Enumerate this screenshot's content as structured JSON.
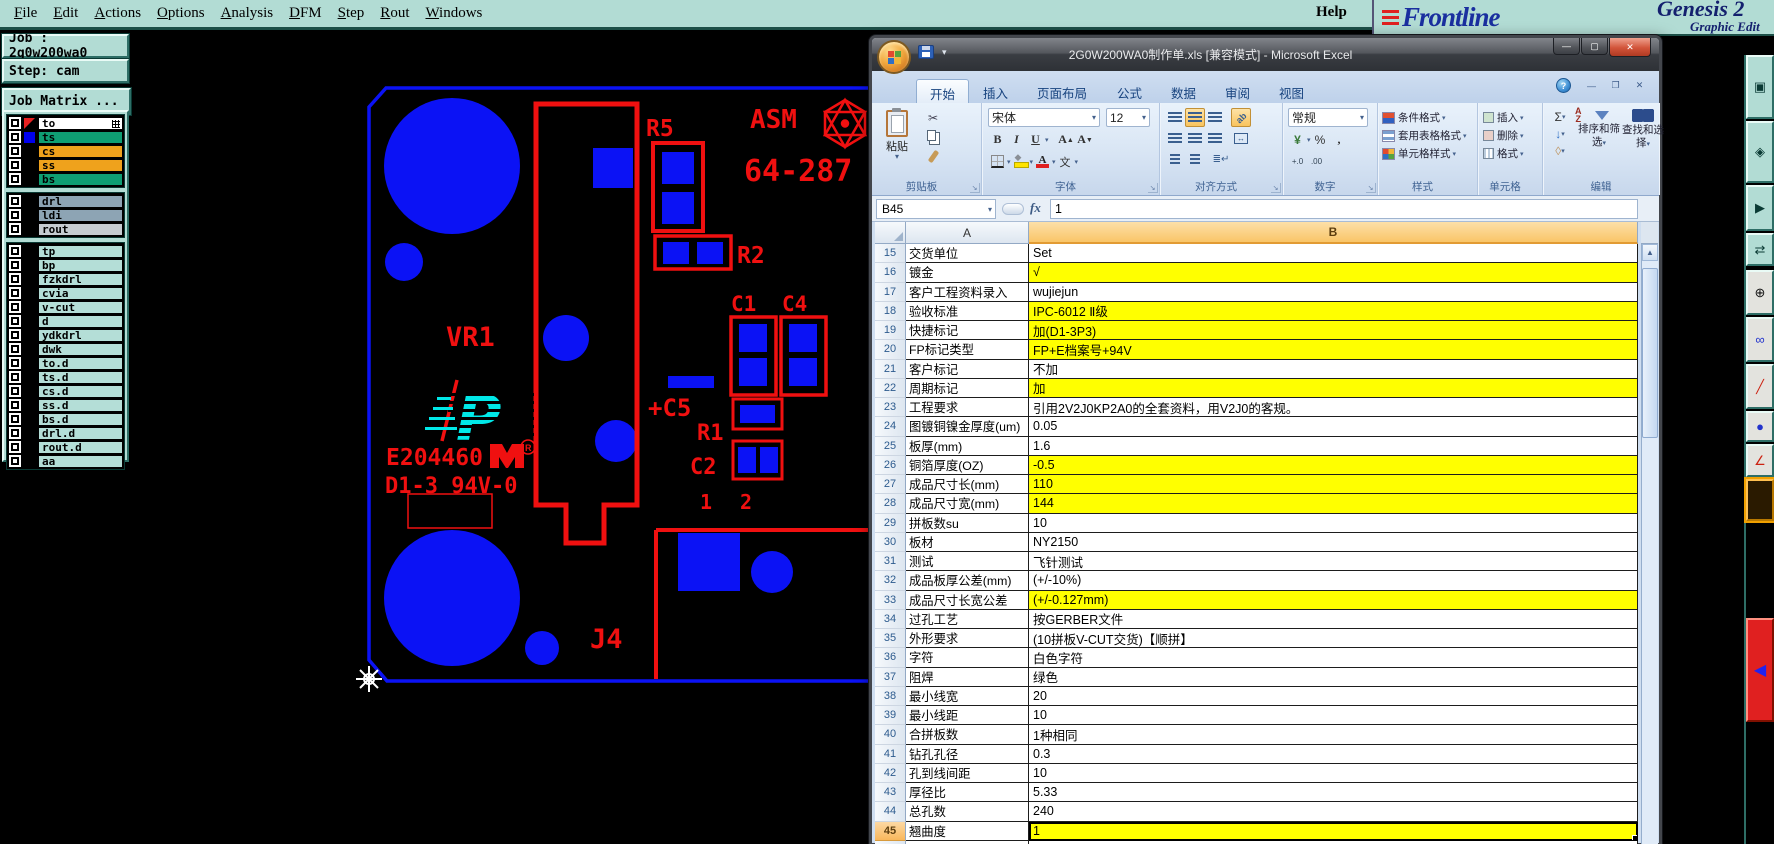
{
  "genesis": {
    "menu": [
      "File",
      "Edit",
      "Actions",
      "Options",
      "Analysis",
      "DFM",
      "Step",
      "Rout",
      "Windows"
    ],
    "help_label": "Help",
    "brand": {
      "name": "Frontline",
      "product": "Genesis 2",
      "subtitle": "Graphic Edit"
    },
    "job_label": "Job : 2g0w200wa0",
    "step_label": "Step: cam",
    "job_matrix_button": "Job Matrix ...",
    "layers": [
      {
        "name": "to",
        "label_bg": "#ffffff",
        "group": 1,
        "active": true,
        "grid_icon": true
      },
      {
        "name": "ts",
        "label_bg": "#0f9e73",
        "group": 1,
        "swatch": "#0000ee"
      },
      {
        "name": "cs",
        "label_bg": "#efa21c",
        "group": 1
      },
      {
        "name": "ss",
        "label_bg": "#efa21c",
        "group": 1
      },
      {
        "name": "bs",
        "label_bg": "#0f9e73",
        "group": 1
      },
      {
        "name": "drl",
        "label_bg": "#8da4b4",
        "group": 2
      },
      {
        "name": "ldi",
        "label_bg": "#8da4b4",
        "group": 2
      },
      {
        "name": "rout",
        "label_bg": "#c5cbd0",
        "group": 2
      },
      {
        "name": "tp",
        "label_bg": "#b4ded7",
        "group": 3
      },
      {
        "name": "bp",
        "label_bg": "#b4ded7",
        "group": 3
      },
      {
        "name": "fzkdrl",
        "label_bg": "#b4ded7",
        "group": 3
      },
      {
        "name": "cvia",
        "label_bg": "#b4ded7",
        "group": 3
      },
      {
        "name": "v-cut",
        "label_bg": "#b4ded7",
        "group": 3
      },
      {
        "name": "d",
        "label_bg": "#b4ded7",
        "group": 3
      },
      {
        "name": "ydkdrl",
        "label_bg": "#b4ded7",
        "group": 3
      },
      {
        "name": "dwk",
        "label_bg": "#b4ded7",
        "group": 3
      },
      {
        "name": "to.d",
        "label_bg": "#b4ded7",
        "group": 3
      },
      {
        "name": "ts.d",
        "label_bg": "#b4ded7",
        "group": 3
      },
      {
        "name": "cs.d",
        "label_bg": "#b4ded7",
        "group": 3
      },
      {
        "name": "ss.d",
        "label_bg": "#b4ded7",
        "group": 3
      },
      {
        "name": "bs.d",
        "label_bg": "#b4ded7",
        "group": 3
      },
      {
        "name": "drl.d",
        "label_bg": "#b4ded7",
        "group": 3
      },
      {
        "name": "rout.d",
        "label_bg": "#b4ded7",
        "group": 3
      },
      {
        "name": "aa",
        "label_bg": "#b4ded7",
        "group": 3
      }
    ],
    "pcb": {
      "r5": "R5",
      "asm": "ASM",
      "part_number": "64-287",
      "r2": "R2",
      "c1": "C1",
      "c4": "C4",
      "vr1": "VR1",
      "c5": "+C5",
      "r1": "R1",
      "c2": "C2",
      "pin1": "1",
      "pin2": "2",
      "j4": "J4",
      "ul_code": "E204460",
      "rating": "D1-3 94V-0",
      "colors": {
        "copper_blue": "#0b12f5",
        "silkscreen_red": "#f01010",
        "logo_cyan": "#00e8e8"
      }
    },
    "right_toolbar": [
      {
        "name": "window-button",
        "style": "teal"
      },
      {
        "name": "diamond-button",
        "style": "teal"
      },
      {
        "name": "play-button",
        "style": "teal"
      },
      {
        "name": "swap-button",
        "style": "teal"
      },
      {
        "name": "crosshair-button",
        "style": "light"
      },
      {
        "name": "link-button",
        "style": "light"
      },
      {
        "name": "slash-button",
        "style": "light"
      },
      {
        "name": "dot-button",
        "style": "light"
      },
      {
        "name": "angle-button",
        "style": "light"
      },
      {
        "name": "active-tool-button",
        "style": "orange"
      },
      {
        "name": "pointer-button",
        "style": "red"
      }
    ]
  },
  "excel": {
    "title": "2G0W200WA0制作单.xls [兼容模式] - Microsoft Excel",
    "tabs": [
      "开始",
      "插入",
      "页面布局",
      "公式",
      "数据",
      "审阅",
      "视图"
    ],
    "active_tab": "开始",
    "ribbon": {
      "clipboard": {
        "label": "剪贴板",
        "paste": "粘贴"
      },
      "font": {
        "label": "字体",
        "font_name": "宋体",
        "font_size": "12",
        "pinyin": "文"
      },
      "alignment": {
        "label": "对齐方式"
      },
      "number": {
        "label": "数字",
        "format": "常规",
        "percent": "%",
        "comma": ",",
        "currency": "¥",
        "dec_add": "+.0",
        "dec_del": ".00"
      },
      "styles": {
        "label": "样式",
        "items": [
          "条件格式",
          "套用表格格式",
          "单元格样式"
        ]
      },
      "cells": {
        "label": "单元格",
        "items": [
          "插入",
          "删除",
          "格式"
        ]
      },
      "editing": {
        "label": "编辑",
        "sum": "Σ",
        "sort": "排序和筛选",
        "find": "查找和选择"
      }
    },
    "name_box": "B45",
    "formula_value": "1",
    "column_headers": [
      "A",
      "B"
    ],
    "selected_cell": "B45",
    "rows": [
      {
        "n": 15,
        "a": "交货单位",
        "b": "Set",
        "y": false
      },
      {
        "n": 16,
        "a": "镀金",
        "b": "√",
        "y": true
      },
      {
        "n": 17,
        "a": "客户工程资料录入",
        "b": "wujiejun",
        "y": false
      },
      {
        "n": 18,
        "a": "验收标准",
        "b": "IPC-6012 Ⅱ级",
        "y": true
      },
      {
        "n": 19,
        "a": "快捷标记",
        "b": "加(D1-3P3)",
        "y": true
      },
      {
        "n": 20,
        "a": "FP标记类型",
        "b": "FP+E档案号+94V",
        "y": true
      },
      {
        "n": 21,
        "a": "客户标记",
        "b": "不加",
        "y": false
      },
      {
        "n": 22,
        "a": "周期标记",
        "b": "加",
        "y": true
      },
      {
        "n": 23,
        "a": "工程要求",
        "b": "引用2V2J0KP2A0的全套资料，用V2J0的客规。",
        "y": false
      },
      {
        "n": 24,
        "a": "图镀铜镍金厚度(um)",
        "b": "0.05",
        "y": false
      },
      {
        "n": 25,
        "a": "板厚(mm)",
        "b": "1.6",
        "y": false
      },
      {
        "n": 26,
        "a": "铜箔厚度(OZ)",
        "b": "-0.5",
        "y": true
      },
      {
        "n": 27,
        "a": "成品尺寸长(mm)",
        "b": "110",
        "y": true
      },
      {
        "n": 28,
        "a": "成品尺寸宽(mm)",
        "b": "144",
        "y": true
      },
      {
        "n": 29,
        "a": "拼板数su",
        "b": "10",
        "y": false
      },
      {
        "n": 30,
        "a": "板材",
        "b": "NY2150",
        "y": false
      },
      {
        "n": 31,
        "a": "测试",
        "b": "飞针测试",
        "y": false
      },
      {
        "n": 32,
        "a": "成品板厚公差(mm)",
        "b": "(+/-10%)",
        "y": false
      },
      {
        "n": 33,
        "a": "成品尺寸长宽公差",
        "b": "(+/-0.127mm)",
        "y": true
      },
      {
        "n": 34,
        "a": "过孔工艺",
        "b": "按GERBER文件",
        "y": false
      },
      {
        "n": 35,
        "a": "外形要求",
        "b": "(10拼板V-CUT交货)【顺拼】",
        "y": false
      },
      {
        "n": 36,
        "a": "字符",
        "b": "白色字符",
        "y": false
      },
      {
        "n": 37,
        "a": "阻焊",
        "b": "绿色",
        "y": false
      },
      {
        "n": 38,
        "a": "最小线宽",
        "b": "20",
        "y": false
      },
      {
        "n": 39,
        "a": "最小线距",
        "b": "10",
        "y": false
      },
      {
        "n": 40,
        "a": "合拼板数",
        "b": "1种相同",
        "y": false
      },
      {
        "n": 41,
        "a": "钻孔孔径",
        "b": "0.3",
        "y": false
      },
      {
        "n": 42,
        "a": "孔到线间距",
        "b": "10",
        "y": false
      },
      {
        "n": 43,
        "a": "厚径比",
        "b": "5.33",
        "y": false
      },
      {
        "n": 44,
        "a": "总孔数",
        "b": "240",
        "y": false
      },
      {
        "n": 45,
        "a": "翘曲度",
        "b": "1",
        "y": true,
        "selected": true
      },
      {
        "n": 46,
        "a": "限制批量",
        "b": "/",
        "y": false
      }
    ]
  }
}
